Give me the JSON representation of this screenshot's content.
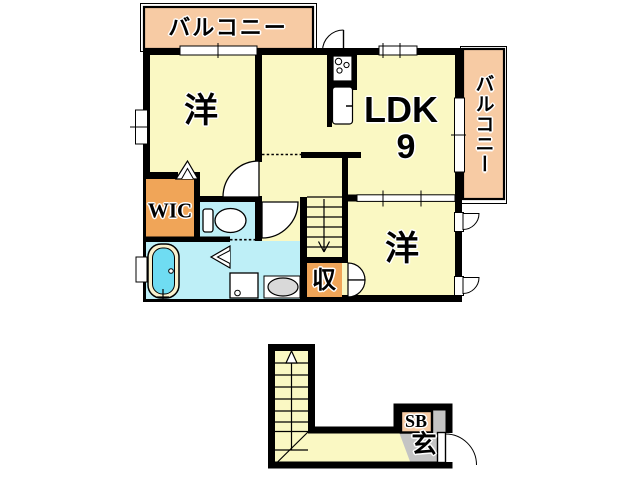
{
  "floor2": {
    "balcony_top": "バルコニー",
    "balcony_right": "バルコニー",
    "bedroom_left": "洋",
    "ldk": "LDK",
    "ldk_size": "9",
    "wic": "WIC",
    "storage": "収",
    "bedroom_right": "洋"
  },
  "floor1": {
    "shoebox": "SB",
    "entrance": "玄"
  },
  "colors": {
    "floor_yellow": "#FAF8C3",
    "balcony_peach": "#F7CBA4",
    "closet_orange": "#F0A558",
    "wet_area_cyan": "#BEEFF7",
    "bathtub_cyan": "#6FDCF2",
    "bathtub_rim": "#F9F1CE",
    "genkan_gray": "#C4C4C4",
    "sink_gray": "#D9D9D9",
    "wall_black": "#000000"
  }
}
